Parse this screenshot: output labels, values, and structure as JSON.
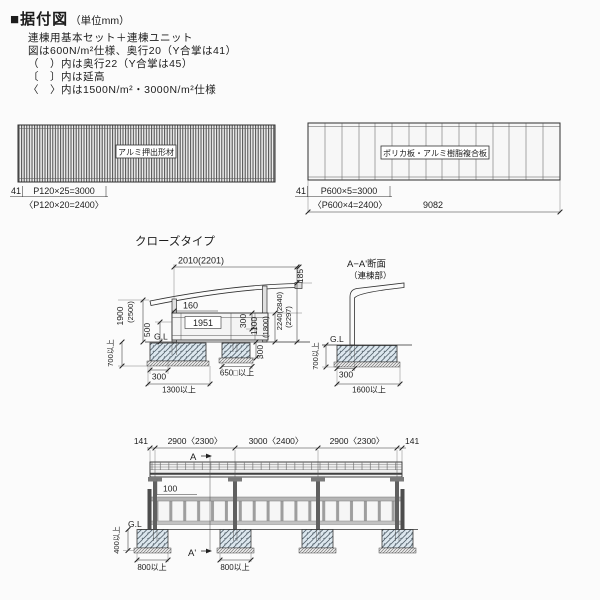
{
  "page": {
    "bullet": "■",
    "title": "据付図",
    "unit_note": "（単位mm）"
  },
  "notes": [
    "連棟用基本セット＋連棟ユニット",
    "図は600N/m²仕様、奥行20（Y合掌は41）",
    "（　）内は奥行22（Y合掌は45）",
    "〔　〕内は延高",
    "〈　〉内は1500N/m²・3000N/m²仕様"
  ],
  "panel_left": {
    "label": "アルミ押出形材",
    "dim_end": "41",
    "dim_pitch": "P120×25=3000",
    "dim_pitch_alt": "〈P120×20=2400〉"
  },
  "panel_right": {
    "label": "ポリカ板・アルミ樹脂複合板",
    "dim_end": "41",
    "dim_pitch": "P600×5=3000",
    "dim_pitch_alt": "〈P600×4=2400〉",
    "dim_total": "9082"
  },
  "close_type": {
    "title": "クローズタイプ",
    "dims": {
      "top": "2010(2201)",
      "rise": "185",
      "eave": "160",
      "panel": "1951",
      "height": "1900",
      "height_alt": "(2500)",
      "lower": "500",
      "gl": "G.L",
      "embed": "700以上",
      "foot_left": "300",
      "foot_width": "1300以上",
      "foot_right": "650□以上",
      "r300": "300",
      "r1100": "1100",
      "r1800": "(1800)",
      "r2240": "2240(2840)",
      "r2297": "(2297)",
      "foot_depth": "300"
    }
  },
  "aa_section": {
    "title": "A−A'断面",
    "subtitle": "（連棟部）",
    "dims": {
      "gl": "G.L",
      "embed": "700以上",
      "foot_left": "300",
      "foot_width": "1600以上"
    }
  },
  "elevation": {
    "dims_top": [
      "141",
      "2900〈2300〉",
      "3000〈2400〉",
      "2900〈2300〉",
      "141"
    ],
    "marker_a": "A",
    "marker_a_prime": "A'",
    "dims": {
      "roof_gap": "100",
      "gl": "G.L",
      "embed": "400以上",
      "foot1": "800以上",
      "foot2": "800以上"
    }
  }
}
